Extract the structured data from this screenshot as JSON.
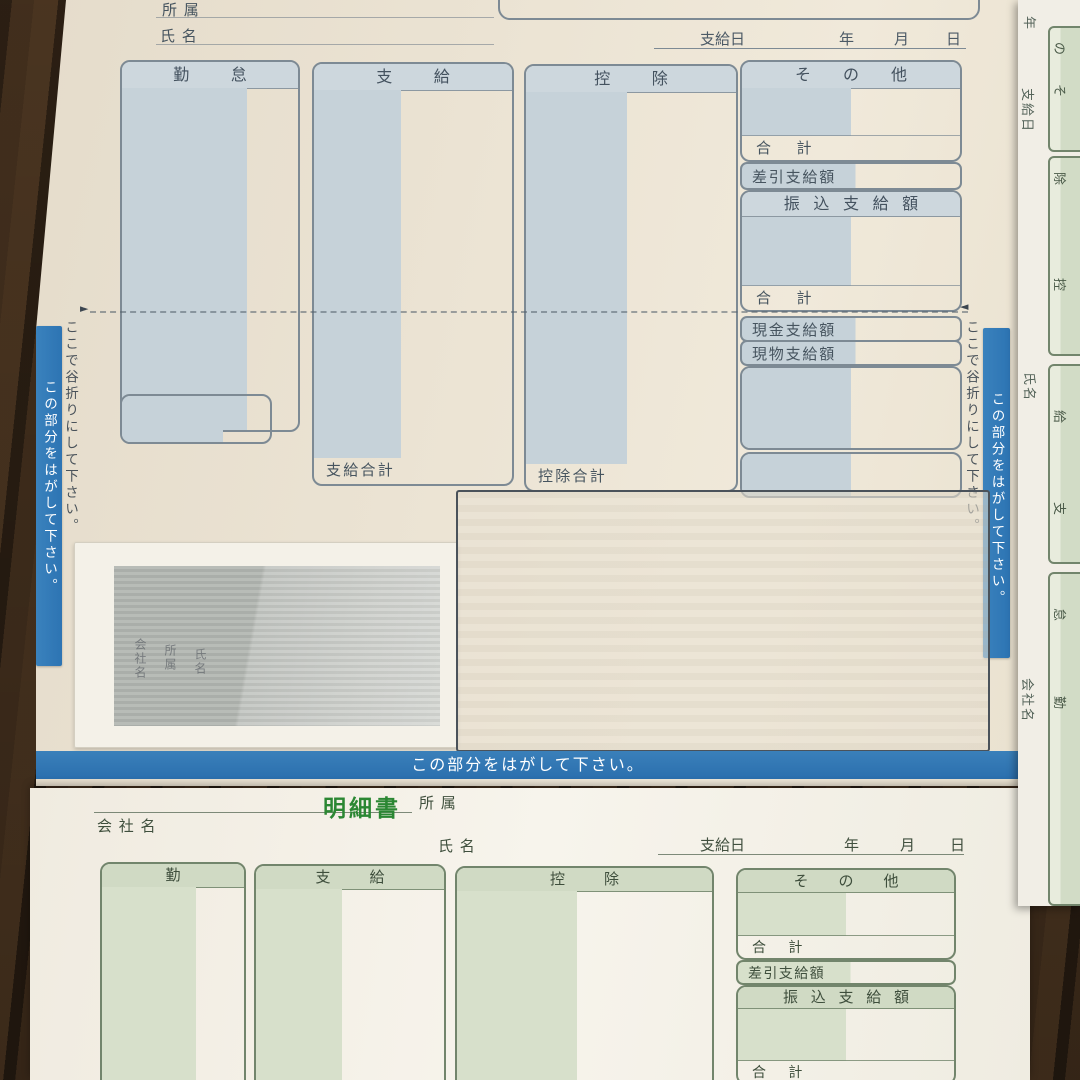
{
  "top_form": {
    "affiliation": "所属",
    "name": "氏名",
    "pay_date": "支給日",
    "year": "年",
    "month": "月",
    "day": "日",
    "col_attendance": "勤怠",
    "col_payment": "支給",
    "col_deduction": "控除",
    "col_other": "その他",
    "total": "合計",
    "net_payment": "差引支給額",
    "transfer_payment": "振込支給額",
    "cash_payment": "現金支給額",
    "inkind_payment": "現物支給額",
    "payment_total": "支給合計",
    "deduction_total": "控除合計",
    "fold_instruction": "ここで谷折りにして下さい。",
    "peel_instruction": "この部分をはがして下さい。",
    "fold_arrow_left": "►",
    "fold_arrow_right": "◄"
  },
  "window_labels": {
    "company": "会社名",
    "affiliation": "所属",
    "name": "氏名"
  },
  "bottom_form": {
    "title": "明細書",
    "company": "会社名",
    "affiliation": "所属",
    "name": "氏名",
    "pay_date": "支給日",
    "year": "年",
    "month": "月",
    "day": "日",
    "col_attendance": "勤怠",
    "col_payment": "支給",
    "col_deduction": "控除",
    "col_other": "その他",
    "total": "合計",
    "net_payment": "差引支給額",
    "transfer_payment": "振込支給額"
  },
  "side_form": {
    "year": "年",
    "pay_date": "支給日",
    "name": "氏名",
    "company": "会社名",
    "col_chars": [
      "の",
      "そ",
      "除",
      "控",
      "給",
      "支",
      "怠",
      "勤"
    ]
  },
  "colors": {
    "banner_blue": "#2d74b3",
    "top_form_accent": "#7d8a94",
    "top_form_shade": "#c6d2d9",
    "bottom_form_accent": "#72856c",
    "bottom_form_shade": "#d7e0cb",
    "title_green": "#2b8733"
  }
}
